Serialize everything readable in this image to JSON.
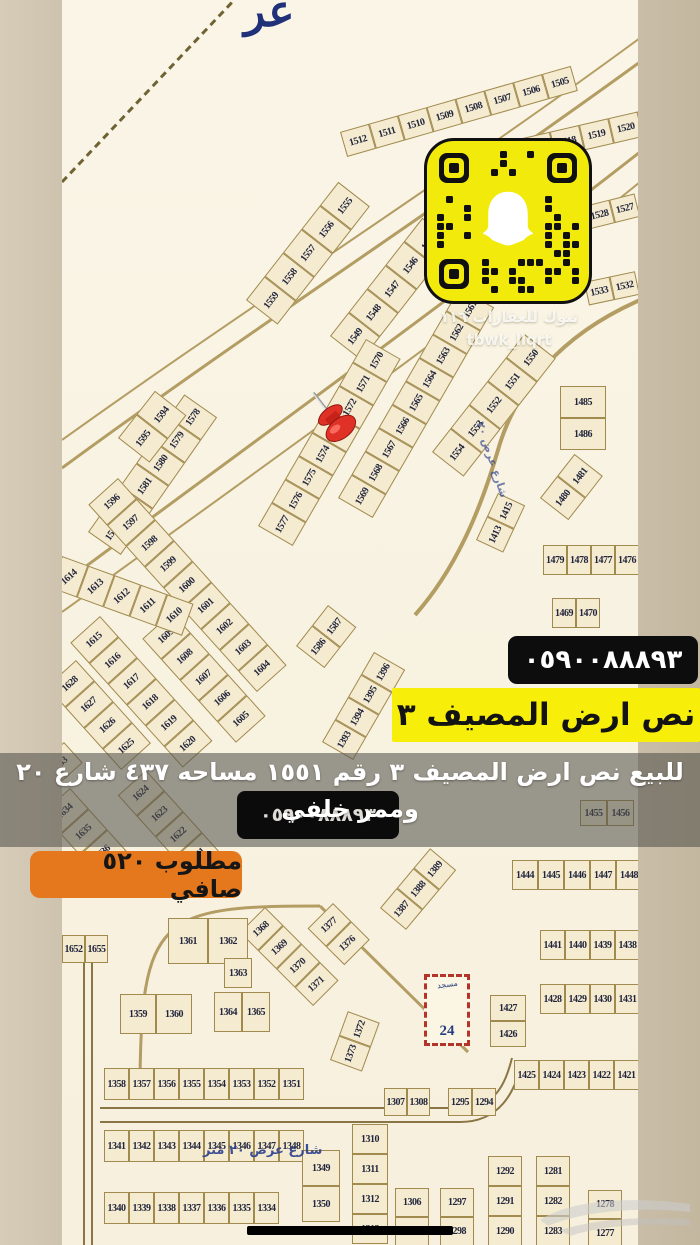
{
  "overlays": {
    "phone": "٠٥٩٠٠٨٨٨٩٣",
    "title": "نص ارض المصيف ٣",
    "desc_line1": "للبيع نص ارض المصيف ٣ رقم ١٥٥١ مساحه ٤٣٧ شارع ٢٠",
    "desc_line2": "وممر خلفي",
    "desc_phone": "٠٥٩٠٠٨٨٨٩٣",
    "price": "مطلوب ٥٢٠ صافي",
    "snap_caption1": "تبوك للعقارات ١١٦",
    "snap_caption2": "tbwk_llqrt"
  },
  "colors": {
    "qr_yellow": "#f2ea0a",
    "banner_yellow": "#f7ef09",
    "badge_orange": "#e5771c",
    "pin_red": "#d42a1e",
    "band_gray": "rgba(84,82,77,0.58)",
    "map_cream": "#f8f2e1",
    "plot_fill": "#f4ebd1",
    "plot_border": "#a18a4e",
    "street_blue": "#2b3f8e"
  },
  "map": {
    "street_label": "شارع عرض ٢٠ متر",
    "street_label_side": "شارع عرض ٢٠",
    "calligraphy": "عر",
    "mosque_number": "24",
    "mosque_word": "مسجد",
    "diag_rows": [
      {
        "x": 340,
        "y": 132,
        "rot": -16,
        "cw": 30,
        "ch": 26,
        "nums": [
          "1512",
          "1511",
          "1510",
          "1509",
          "1508",
          "1507",
          "1506",
          "1505"
        ]
      },
      {
        "x": 462,
        "y": 152,
        "rot": -13,
        "cw": 30,
        "ch": 26,
        "nums": [
          "1515",
          "1516",
          "1517",
          "1518",
          "1519",
          "1520",
          "1521"
        ]
      },
      {
        "x": 246,
        "y": 300,
        "rot": -52,
        "cw": 30,
        "ch": 40,
        "nums": [
          "1559",
          "1558",
          "1557",
          "1556",
          "1555"
        ]
      },
      {
        "x": 330,
        "y": 336,
        "rot": -52,
        "cw": 30,
        "ch": 40,
        "nums": [
          "1549",
          "1548",
          "1547",
          "1546",
          "1545"
        ]
      },
      {
        "x": 432,
        "y": 452,
        "rot": -52,
        "cw": 30,
        "ch": 40,
        "nums": [
          "1554",
          "1553",
          "1552",
          "1551",
          "1550"
        ]
      },
      {
        "x": 338,
        "y": 498,
        "rot": -60,
        "cw": 27,
        "ch": 40,
        "nums": [
          "1569",
          "1568",
          "1567",
          "1566",
          "1565",
          "1564",
          "1563",
          "1562",
          "1561"
        ]
      },
      {
        "x": 258,
        "y": 526,
        "rot": -60,
        "cw": 27,
        "ch": 40,
        "nums": [
          "1577",
          "1576",
          "1575",
          "1574",
          "1573",
          "1572",
          "1571",
          "1570"
        ]
      },
      {
        "x": 88,
        "y": 532,
        "rot": -55,
        "cw": 28,
        "ch": 40,
        "nums": [
          "1583",
          "1582",
          "1581",
          "1580",
          "1579",
          "1578"
        ]
      },
      {
        "x": 118,
        "y": 438,
        "rot": -52,
        "cw": 30,
        "ch": 40,
        "nums": [
          "1595",
          "1594"
        ]
      },
      {
        "x": 118,
        "y": 478,
        "rot": 48,
        "cw": 28,
        "ch": 40,
        "flip": true,
        "nums": [
          "1596",
          "1597",
          "1598",
          "1599",
          "1600",
          "1601",
          "1602",
          "1603",
          "1604"
        ]
      },
      {
        "x": 172,
        "y": 612,
        "rot": 48,
        "cw": 28,
        "ch": 40,
        "flip": true,
        "nums": [
          "1609",
          "1608",
          "1607",
          "1606",
          "1605"
        ]
      },
      {
        "x": 62,
        "y": 556,
        "rot": 20,
        "cw": 28,
        "ch": 34,
        "flip": true,
        "nums": [
          "1614",
          "1613",
          "1612",
          "1611",
          "1610"
        ]
      },
      {
        "x": 100,
        "y": 616,
        "rot": 48,
        "cw": 28,
        "ch": 40,
        "flip": true,
        "nums": [
          "1615",
          "1616",
          "1617",
          "1618",
          "1619",
          "1620"
        ]
      },
      {
        "x": 76,
        "y": 660,
        "rot": 48,
        "cw": 28,
        "ch": 40,
        "flip": true,
        "nums": [
          "1628",
          "1627",
          "1626",
          "1625"
        ]
      },
      {
        "x": 64,
        "y": 742,
        "rot": 48,
        "cw": 28,
        "ch": 36,
        "flip": true,
        "nums": [
          "1633"
        ]
      },
      {
        "x": 146,
        "y": 770,
        "rot": 48,
        "cw": 28,
        "ch": 38,
        "flip": true,
        "nums": [
          "1624",
          "1623",
          "1622",
          "1621"
        ]
      },
      {
        "x": 70,
        "y": 788,
        "rot": 48,
        "cw": 28,
        "ch": 38,
        "flip": true,
        "nums": [
          "1634",
          "1635",
          "1636",
          "1637"
        ]
      },
      {
        "x": 296,
        "y": 646,
        "rot": -52,
        "cw": 26,
        "ch": 36,
        "nums": [
          "1586",
          "1587"
        ]
      },
      {
        "x": 322,
        "y": 742,
        "rot": -60,
        "cw": 26,
        "ch": 36,
        "nums": [
          "1393",
          "1394",
          "1395",
          "1396"
        ]
      },
      {
        "x": 540,
        "y": 498,
        "rot": -52,
        "cw": 28,
        "ch": 36,
        "nums": [
          "1480",
          "1481"
        ]
      },
      {
        "x": 584,
        "y": 206,
        "rot": -14,
        "cw": 26,
        "ch": 24,
        "nums": [
          "1528",
          "1527"
        ]
      },
      {
        "x": 584,
        "y": 282,
        "rot": -12,
        "cw": 26,
        "ch": 24,
        "nums": [
          "1533",
          "1532"
        ]
      },
      {
        "x": 380,
        "y": 908,
        "rot": -50,
        "cw": 26,
        "ch": 34,
        "nums": [
          "1387",
          "1388",
          "1389"
        ]
      },
      {
        "x": 265,
        "y": 907,
        "rot": 45,
        "cw": 26,
        "ch": 36,
        "flip": true,
        "nums": [
          "1368",
          "1369",
          "1370",
          "1371"
        ]
      },
      {
        "x": 333,
        "y": 903,
        "rot": 45,
        "cw": 26,
        "ch": 36,
        "flip": true,
        "nums": [
          "1377",
          "1376"
        ]
      },
      {
        "x": 330,
        "y": 1060,
        "rot": -70,
        "cw": 26,
        "ch": 34,
        "nums": [
          "1373",
          "1372"
        ]
      },
      {
        "x": 476,
        "y": 540,
        "rot": -65,
        "cw": 26,
        "ch": 30,
        "nums": [
          "1413",
          "1415"
        ]
      }
    ],
    "grid_rows": [
      {
        "x": 104,
        "y": 1068,
        "cw": 25,
        "ch": 32,
        "nums": [
          "1358",
          "1357",
          "1356",
          "1355",
          "1354",
          "1353",
          "1352",
          "1351"
        ]
      },
      {
        "x": 104,
        "y": 1130,
        "cw": 25,
        "ch": 32,
        "nums": [
          "1341",
          "1342",
          "1343",
          "1344",
          "1345",
          "1346",
          "1347",
          "1348"
        ]
      },
      {
        "x": 104,
        "y": 1192,
        "cw": 25,
        "ch": 32,
        "nums": [
          "1340",
          "1339",
          "1338",
          "1337",
          "1336",
          "1335",
          "1334"
        ]
      },
      {
        "x": 540,
        "y": 984,
        "cw": 25,
        "ch": 30,
        "nums": [
          "1428",
          "1429",
          "1430",
          "1431"
        ]
      },
      {
        "x": 514,
        "y": 1060,
        "cw": 25,
        "ch": 30,
        "nums": [
          "1425",
          "1424",
          "1423",
          "1422",
          "1421"
        ]
      },
      {
        "x": 512,
        "y": 860,
        "cw": 26,
        "ch": 30,
        "nums": [
          "1444",
          "1445",
          "1446",
          "1447",
          "1448"
        ]
      },
      {
        "x": 540,
        "y": 930,
        "cw": 25,
        "ch": 30,
        "nums": [
          "1441",
          "1440",
          "1439",
          "1438"
        ]
      },
      {
        "x": 384,
        "y": 1088,
        "cw": 23,
        "ch": 28,
        "nums": [
          "1307",
          "1308"
        ]
      },
      {
        "x": 448,
        "y": 1088,
        "cw": 24,
        "ch": 28,
        "nums": [
          "1295",
          "1294"
        ]
      },
      {
        "x": 580,
        "y": 800,
        "cw": 27,
        "ch": 26,
        "nums": [
          "1455",
          "1456"
        ]
      },
      {
        "x": 168,
        "y": 918,
        "cw": 40,
        "ch": 46,
        "nums": [
          "1361",
          "1362"
        ]
      },
      {
        "x": 214,
        "y": 992,
        "cw": 28,
        "ch": 40,
        "nums": [
          "1364",
          "1365"
        ]
      },
      {
        "x": 120,
        "y": 994,
        "cw": 36,
        "ch": 40,
        "nums": [
          "1359",
          "1360"
        ]
      },
      {
        "x": 62,
        "y": 935,
        "cw": 23,
        "ch": 28,
        "nums": [
          "1652",
          "1655"
        ]
      },
      {
        "x": 543,
        "y": 545,
        "cw": 24,
        "ch": 30,
        "nums": [
          "1479",
          "1478",
          "1477",
          "1476"
        ]
      },
      {
        "x": 552,
        "y": 598,
        "cw": 24,
        "ch": 30,
        "nums": [
          "1469",
          "1470"
        ]
      },
      {
        "x": 224,
        "y": 958,
        "cw": 28,
        "ch": 30,
        "nums": [
          "1363"
        ]
      }
    ],
    "grid_cols": [
      {
        "x": 560,
        "y": 386,
        "cw": 46,
        "ch": 32,
        "nums": [
          "1485",
          "1486"
        ]
      },
      {
        "x": 490,
        "y": 995,
        "cw": 36,
        "ch": 26,
        "nums": [
          "1427",
          "1426"
        ]
      },
      {
        "x": 352,
        "y": 1124,
        "cw": 36,
        "ch": 30,
        "nums": [
          "1310",
          "1311",
          "1312",
          "1313"
        ]
      },
      {
        "x": 302,
        "y": 1150,
        "cw": 38,
        "ch": 36,
        "nums": [
          "1349",
          "1350"
        ]
      },
      {
        "x": 395,
        "y": 1188,
        "cw": 34,
        "ch": 29,
        "nums": [
          "1306",
          "1305"
        ]
      },
      {
        "x": 440,
        "y": 1188,
        "cw": 34,
        "ch": 29,
        "nums": [
          "1297",
          "1298"
        ]
      },
      {
        "x": 488,
        "y": 1156,
        "cw": 34,
        "ch": 30,
        "nums": [
          "1292",
          "1291",
          "1290"
        ]
      },
      {
        "x": 536,
        "y": 1156,
        "cw": 34,
        "ch": 30,
        "nums": [
          "1281",
          "1282",
          "1283"
        ]
      },
      {
        "x": 588,
        "y": 1190,
        "cw": 34,
        "ch": 29,
        "nums": [
          "1278",
          "1277"
        ]
      }
    ]
  }
}
